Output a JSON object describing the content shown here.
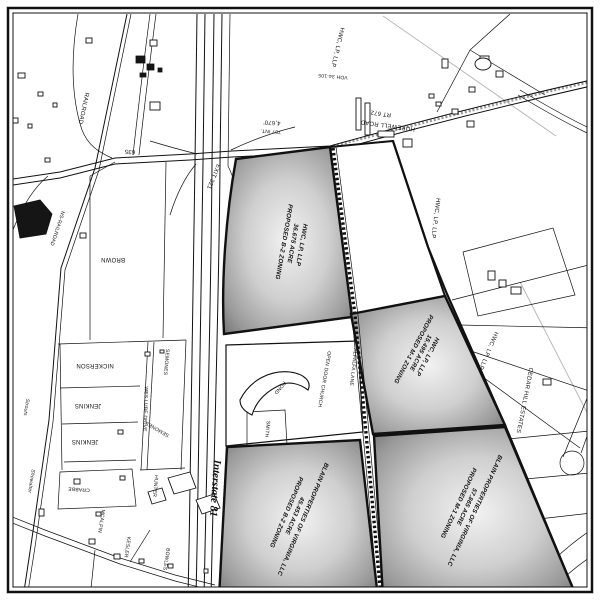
{
  "map": {
    "parcels": {
      "p1": {
        "owner": "HWC, LP, LLP",
        "acreage": "36.675 ACRE",
        "zoning": "PROPOSED B-2 ZONING"
      },
      "p2": {
        "owner": "HWC, LP, LLP",
        "acreage": "15.495 ACRE",
        "zoning": "PROPOSED M-1 ZONING"
      },
      "p3": {
        "owner": "BLAIN PROPERTIES OF VIRGINIA, LLC",
        "acreage": "57.865 ACRE",
        "zoning": "PROPOSED M-1 ZONING"
      },
      "p4": {
        "owner": "BLAIN PROPERTIES OF VIRGINIA, LLC",
        "acreage": "45.453 ACRE",
        "zoning": "PROPOSED B-2 ZONING"
      }
    },
    "roads": {
      "interstate": "Interstate 81",
      "hopewell": "HOPEWELL ROAD",
      "rt672": "RT 672",
      "route635": "635",
      "exit321": "EXIT 321",
      "alfalfa": "ALFALFA LANE",
      "weslube": "WES LUBE DRIVE",
      "railroad": "RAILROAD",
      "railroad2": "NS-RAILROAD"
    },
    "annotations": {
      "dist1": "4,670'",
      "dist2": "757 INT.",
      "vdh": "VDH 34-105"
    },
    "owners": {
      "brown": "BROWN",
      "nickerson": "NICKERSON",
      "jenkins_a": "JENKINS",
      "jenkins_b": "JENKINS",
      "semones_a": "SEMONES",
      "semones_b": "SEMONES",
      "smith": "SMITH",
      "crabbe": "CRABBE",
      "strouts": "Strouts",
      "showalter": "Showalter",
      "mcalpin": "MCALPIN",
      "kesler": "KESLER",
      "hunter": "HUNTER",
      "bowles": "BOWLES",
      "davis": "DAVIS",
      "hodgson": "HODGSON 7",
      "hwc_a": "HWC, LP, LLP",
      "hwc_b": "HWC, LP, LLP",
      "hwc_c": "HWC, LP, LLP"
    },
    "places": {
      "church": "OPEN DOOR CHURCH",
      "pond": "POND",
      "cedar": "CEDAR HILL ESTATES"
    }
  }
}
